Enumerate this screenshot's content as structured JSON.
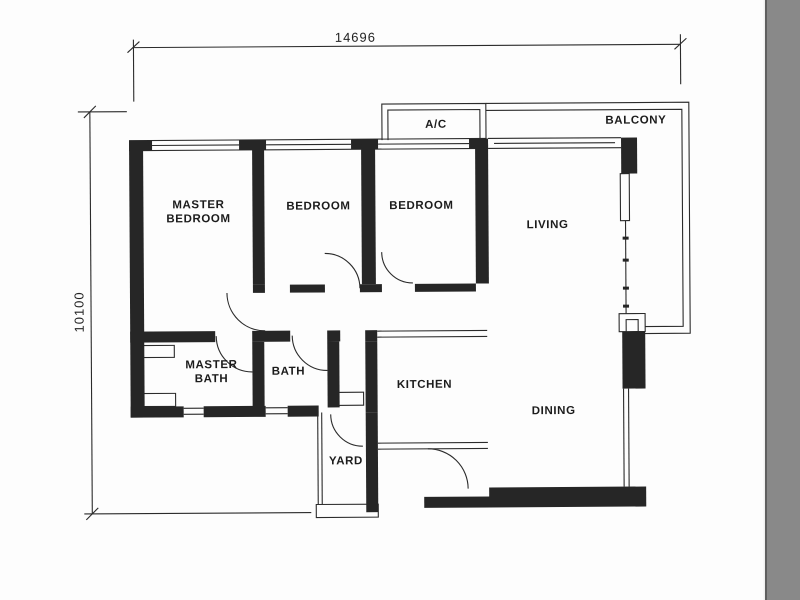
{
  "drawing": {
    "type": "apartment floor plan",
    "dimensions": {
      "width_label": "14696",
      "height_label": "10100"
    },
    "rooms": {
      "master_bedroom": {
        "line1": "MASTER",
        "line2": "BEDROOM"
      },
      "bedroom_1": "BEDROOM",
      "bedroom_2": "BEDROOM",
      "living": "LIVING",
      "balcony": "BALCONY",
      "ac": "A/C",
      "master_bath": {
        "line1": "MASTER",
        "line2": "BATH"
      },
      "bath": "BATH",
      "kitchen": "KITCHEN",
      "dining": "DINING",
      "yard": "YARD"
    },
    "colors": {
      "wall": "#262626",
      "line": "#2b2b2b",
      "paper": "#fdfdfd",
      "scan_band": "#898989"
    }
  }
}
